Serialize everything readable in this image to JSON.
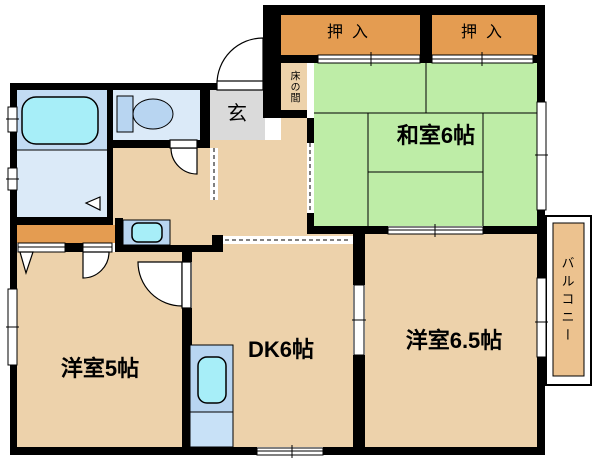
{
  "floorplan": {
    "type": "apartment-floor-plan",
    "rooms": {
      "washitsu": {
        "label": "和室6帖"
      },
      "dk": {
        "label": "DK6帖"
      },
      "western5": {
        "label": "洋室5帖"
      },
      "western65": {
        "label": "洋室6.5帖"
      },
      "genkan": {
        "label": "玄"
      },
      "tokonoma": {
        "label": "床の間"
      },
      "closet_left": {
        "label": "押入"
      },
      "closet_right": {
        "label": "押入"
      },
      "balcony": {
        "label": "バルコニー"
      }
    },
    "fixtures": [
      "bathtub",
      "toilet",
      "washing-machine",
      "kitchen-sink"
    ],
    "colors": {
      "wall": "#000000",
      "room_tan": "#EDD2AB",
      "closet_orange": "#E49C51",
      "tatami_green": "#BEEDA7",
      "entry_gray": "#DADADA",
      "bath_blue": "#C2DBF3",
      "wet_room_blue": "#DBEAF8",
      "fixture_blue": "#B8D5F1",
      "water_cyan": "#A7EEF8",
      "kitchen_low_blue": "#C8E1F7",
      "balcony_orange": "#ECC28F"
    }
  }
}
